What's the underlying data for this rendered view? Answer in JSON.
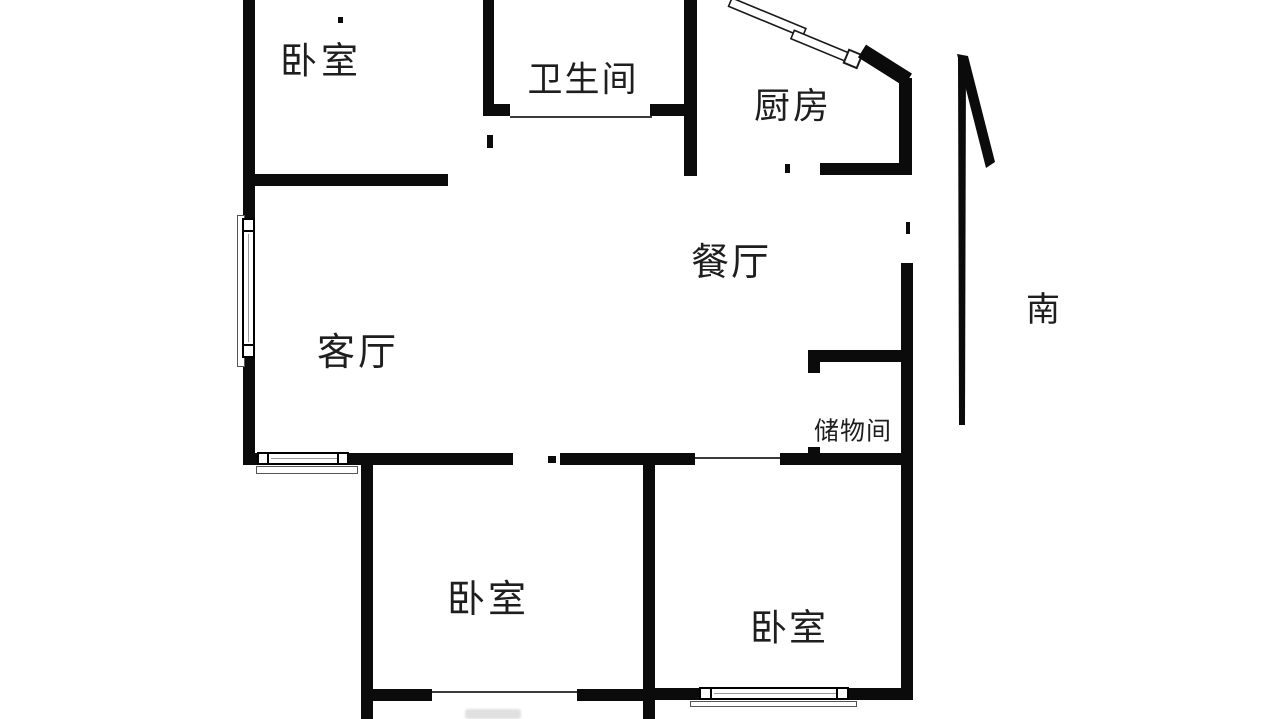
{
  "plan_title": "apartment-floor-plan",
  "rooms": {
    "bedroom_top_left": {
      "label": "卧室"
    },
    "bathroom": {
      "label": "卫生间"
    },
    "kitchen": {
      "label": "厨房"
    },
    "dining": {
      "label": "餐厅"
    },
    "living": {
      "label": "客厅"
    },
    "storage": {
      "label": "储物间"
    },
    "bedroom_bottom_middle": {
      "label": "卧室"
    },
    "bedroom_bottom_right": {
      "label": "卧室"
    }
  },
  "compass": {
    "south_label": "南",
    "direction": "up-arrow"
  },
  "colors": {
    "wall": "#0b0b0b",
    "background": "#ffffff",
    "text": "#1e1e1e"
  }
}
